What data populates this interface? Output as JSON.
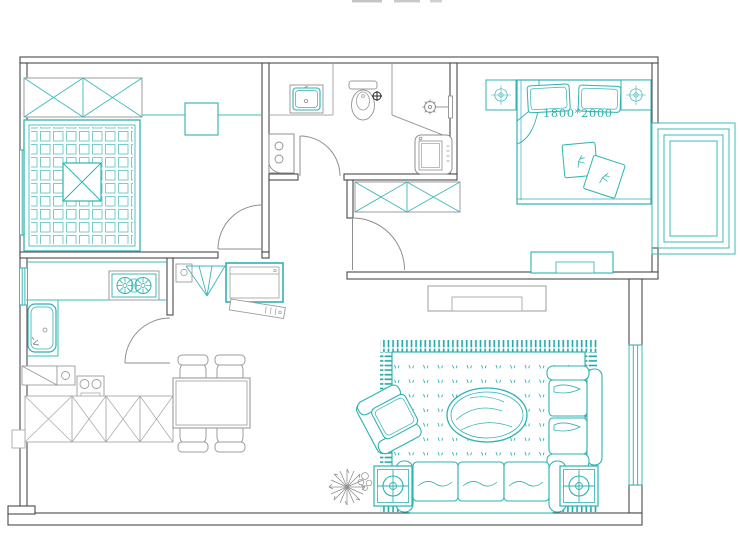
{
  "plan": {
    "type": "apartment-floor-plan",
    "bed_size_label": "1800*2000",
    "colors": {
      "wall": "#4a4a4a",
      "fixture_grey": "#9c9c9c",
      "furniture_teal": "#2fb2b2",
      "rug_teal": "#2aabab",
      "tatami_grid_teal": "#6ac9c9",
      "background": "#ffffff"
    },
    "rooms": [
      {
        "id": "tatami-bedroom",
        "furniture": [
          "wardrobe-with-x-panels",
          "tatami-platform-grid",
          "center-lift-table",
          "side-desk",
          "left-wall-windows",
          "entry-door"
        ]
      },
      {
        "id": "bathroom",
        "furniture": [
          "wash-basin",
          "toilet",
          "shower-head",
          "shower-partition",
          "washing-machine",
          "water-heater-cabinet",
          "swing-door"
        ]
      },
      {
        "id": "master-bedroom",
        "furniture": [
          "double-bed",
          "two-pillows",
          "blanket-fold",
          "two-bedside-lamps",
          "bed-cushions",
          "wardrobe-with-x-panels",
          "low-dresser",
          "bay-window",
          "swing-door"
        ]
      },
      {
        "id": "kitchen",
        "furniture": [
          "l-counter",
          "two-burner-gas-stove",
          "deep-sink-basin",
          "swing-door",
          "base-cabinets-x",
          "utility-sink",
          "double-hob-unit"
        ]
      },
      {
        "id": "entry-hall",
        "furniture": [
          "switch-box",
          "fan-corner-shelf",
          "shoe-cabinet",
          "slanted-board",
          "hall-cabinet"
        ]
      },
      {
        "id": "dining-room",
        "furniture": [
          "dining-table",
          "chair",
          "chair",
          "chair",
          "chair"
        ]
      },
      {
        "id": "living-room",
        "furniture": [
          "fringed-area-rug",
          "oval-coffee-table",
          "armchair",
          "loveseat",
          "three-seat-sofa",
          "two-side-tables",
          "two-table-lamps",
          "potted-plant",
          "small-plant-scribble",
          "right-wall-window"
        ]
      }
    ],
    "top_edge_artifact": "cropped illegible text"
  }
}
